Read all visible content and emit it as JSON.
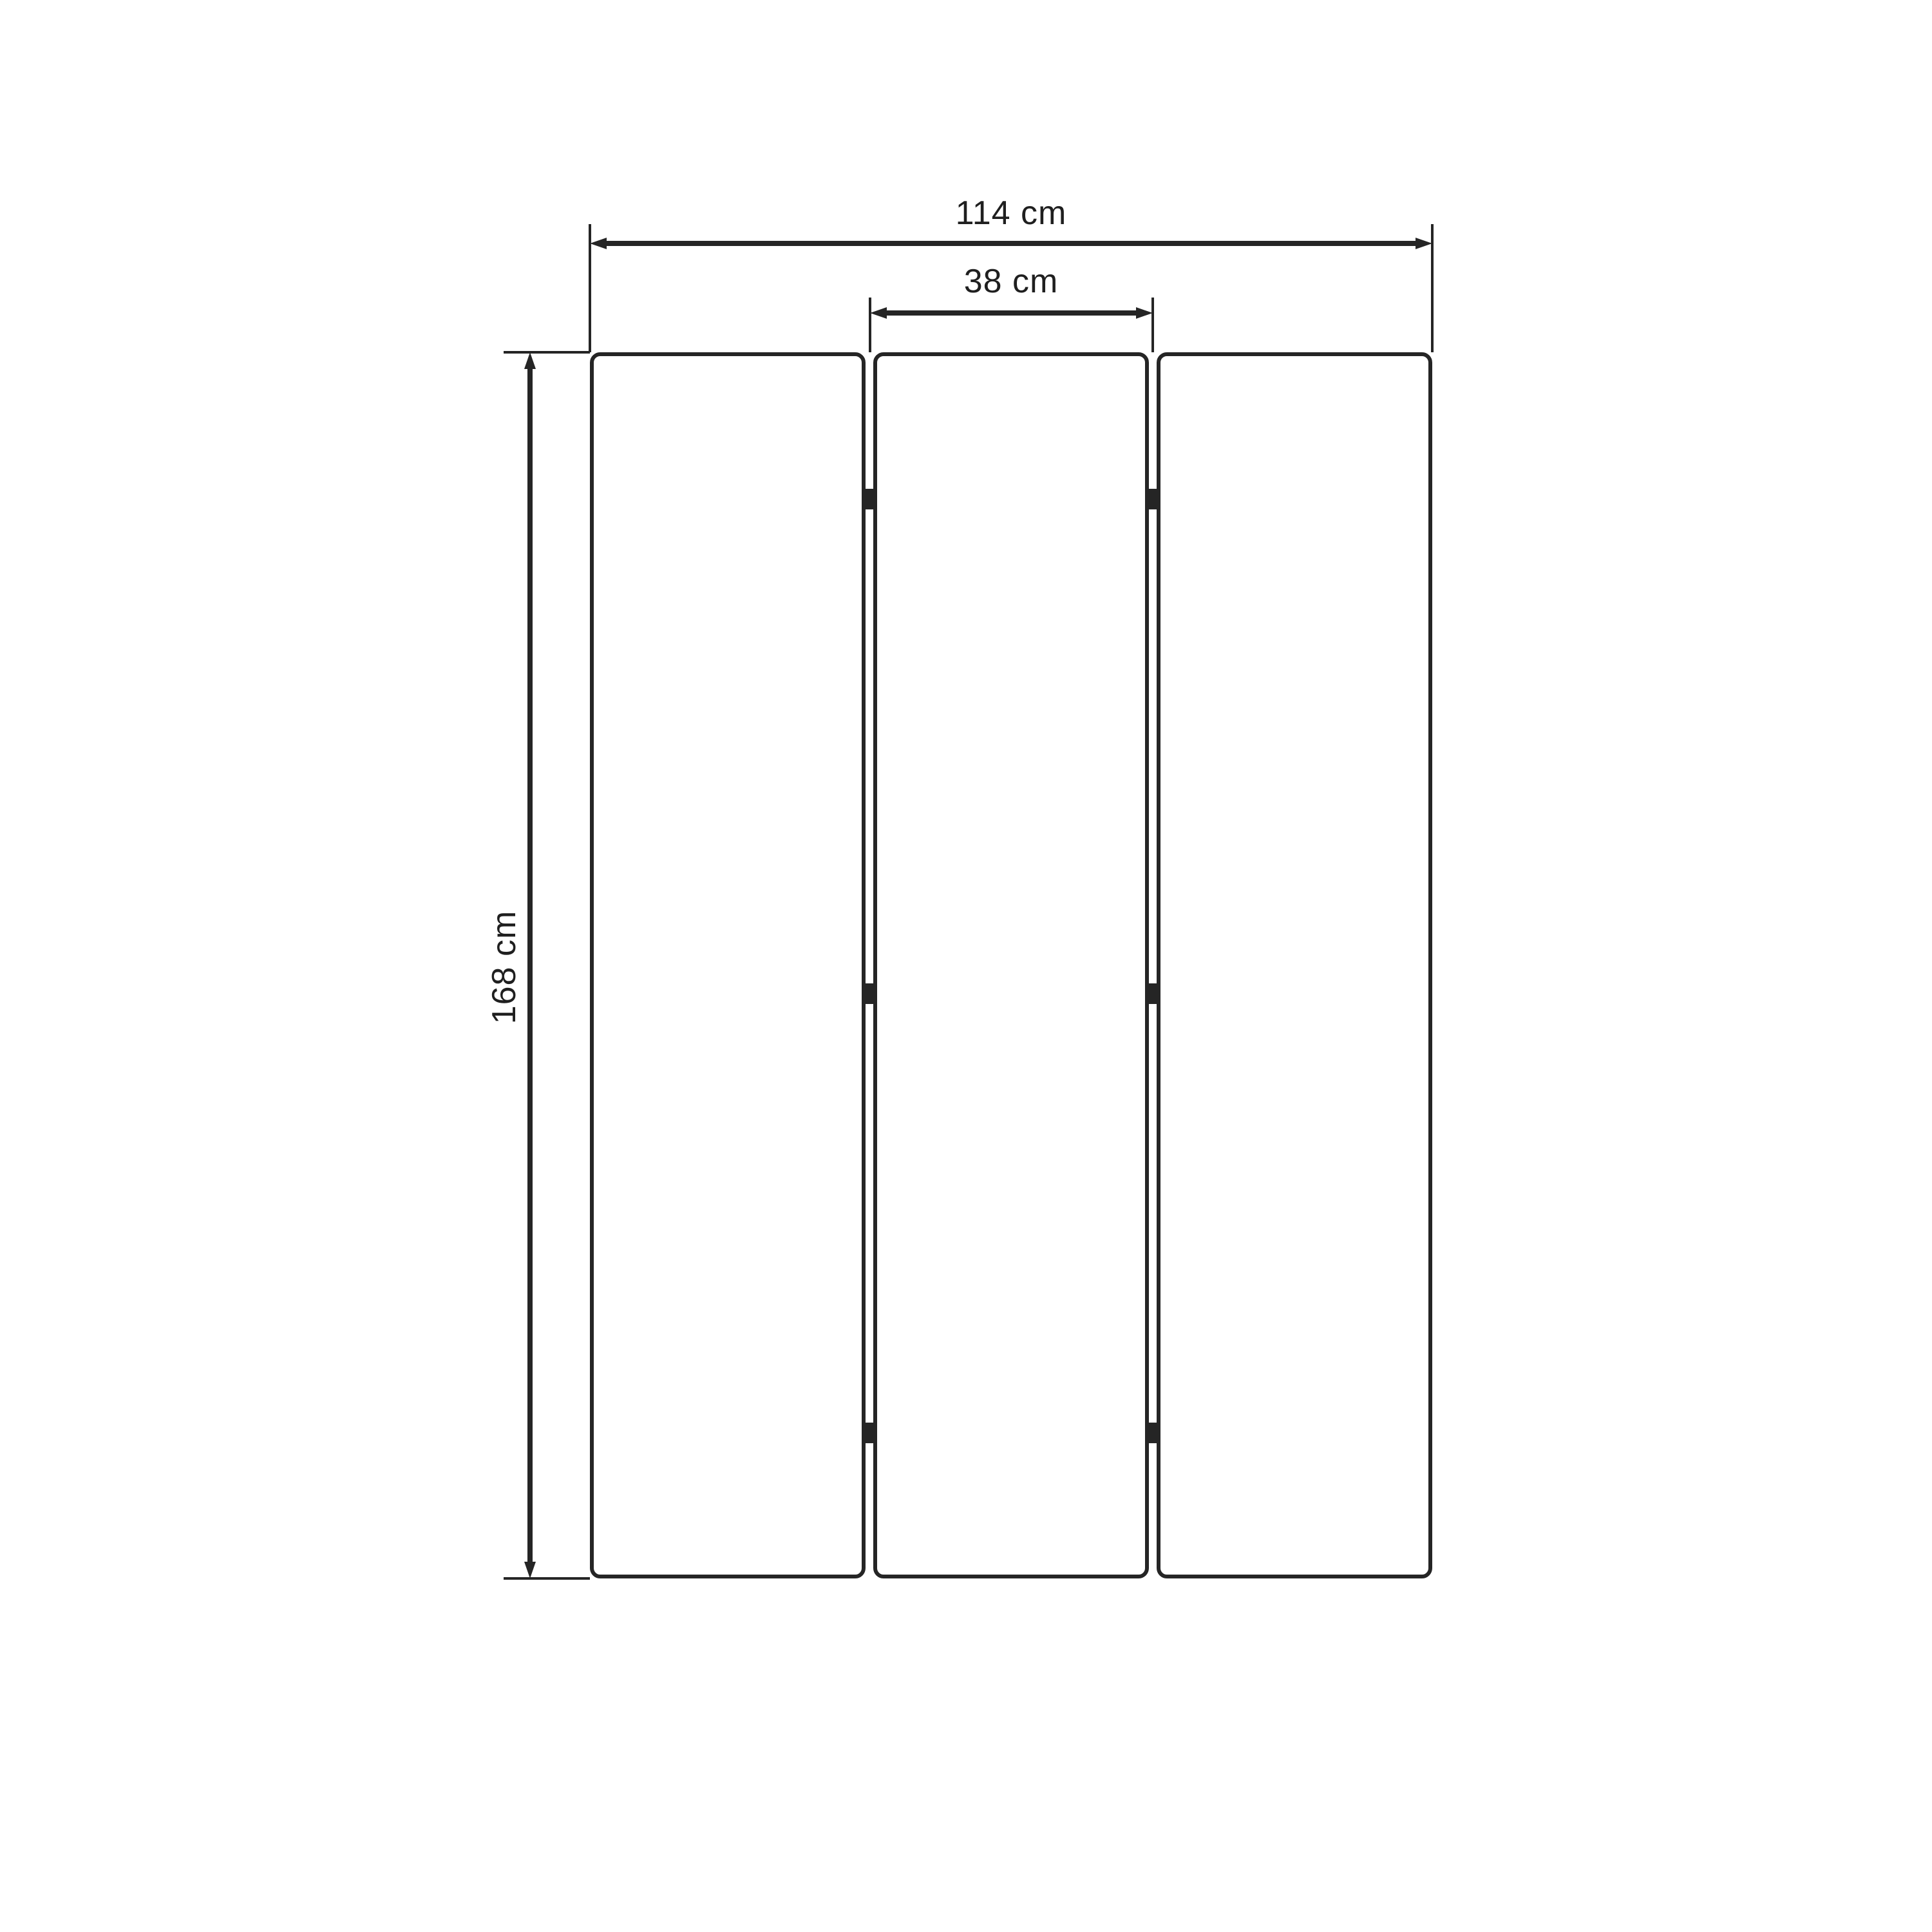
{
  "page": {
    "background_color": "#ffffff"
  },
  "diagram": {
    "type": "technical-dimension-drawing",
    "subject": "three-panel-folding-screen-front-view",
    "panel_count": 3,
    "hinge_rows": 3,
    "colors": {
      "line": "#252525",
      "text": "#1f1f1f",
      "panel_fill": "#ffffff"
    },
    "dimensions": {
      "total_width": {
        "label": "114 cm"
      },
      "panel_width": {
        "label": "38 cm"
      },
      "height": {
        "label": "168 cm"
      }
    }
  }
}
